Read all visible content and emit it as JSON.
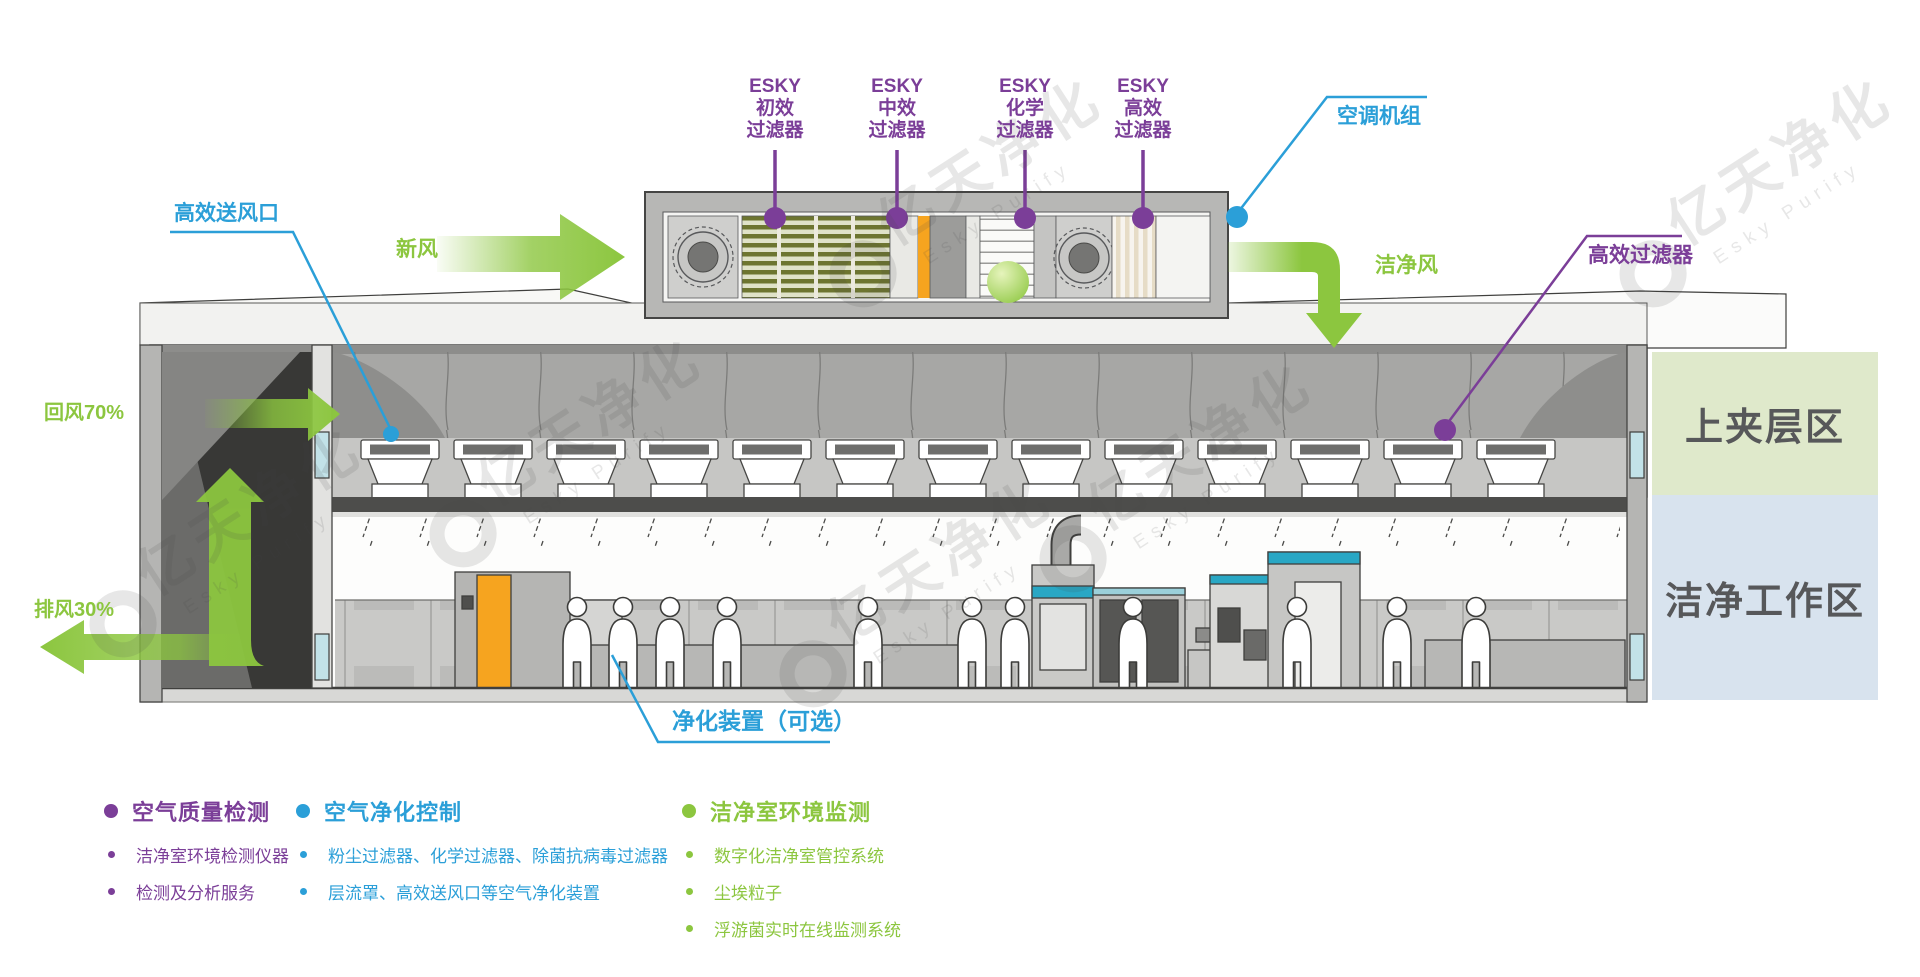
{
  "diagram": {
    "filters": [
      {
        "line1": "ESKY",
        "line2": "初效",
        "line3": "过滤器"
      },
      {
        "line1": "ESKY",
        "line2": "中效",
        "line3": "过滤器"
      },
      {
        "line1": "ESKY",
        "line2": "化学",
        "line3": "过滤器"
      },
      {
        "line1": "ESKY",
        "line2": "高效",
        "line3": "过滤器"
      }
    ],
    "callouts": {
      "ahu_unit": "空调机组",
      "hepa_supply_outlet": "高效送风口",
      "hepa_filter": "高效过滤器",
      "purifier_optional": "净化装置（可选）"
    },
    "airflow": {
      "fresh_air": "新风",
      "clean_air": "洁净风",
      "return_air": "回风70%",
      "exhaust_air": "排风30%"
    },
    "zones": {
      "upper_plenum": "上夹层区",
      "clean_work": "洁净工作区"
    },
    "watermark": {
      "cn": "亿天净化",
      "en": "Esky Purify"
    }
  },
  "legend": {
    "columns": [
      {
        "title": "空气质量检测",
        "color": "#7b3e98",
        "items": [
          "洁净室环境检测仪器",
          "检测及分析服务"
        ]
      },
      {
        "title": "空气净化控制",
        "color": "#2b9fd8",
        "items": [
          "粉尘过滤器、化学过滤器、除菌抗病毒过滤器",
          "层流罩、高效送风口等空气净化装置"
        ]
      },
      {
        "title": "洁净室环境监测",
        "color": "#8cc63f",
        "items": [
          "数字化洁净室管控系统",
          "尘埃粒子",
          "浮游菌实时在线监测系统"
        ]
      }
    ]
  },
  "colors": {
    "purple": "#7b3e98",
    "blue": "#2b9fd8",
    "green": "#8cc63f",
    "zone_upper_bg": "#dfe9cb",
    "zone_work_bg": "#d8e3ee",
    "accent_orange": "#f6a41f",
    "accent_teal": "#29a7c4"
  }
}
